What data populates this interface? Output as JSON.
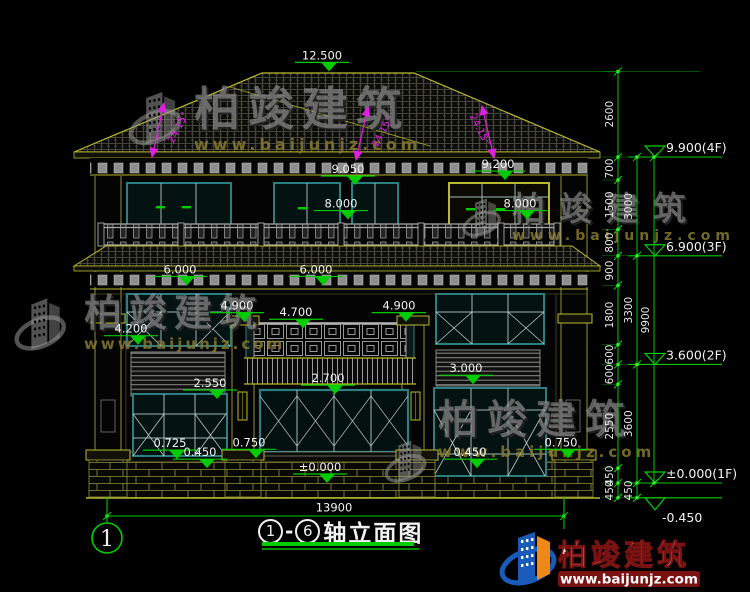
{
  "title_bar": {
    "axis_from": "1",
    "axis_to": "6",
    "dash": "-",
    "title_text": "轴立面图"
  },
  "axis_bubble_label": "1",
  "bottom_dim": {
    "total_width": "13900"
  },
  "building_markers": [
    {
      "label": "12.500",
      "x": 322,
      "mm": 12500
    },
    {
      "label": "9.050",
      "x": 348,
      "mm": 9050
    },
    {
      "label": "9.200",
      "x": 498,
      "mm": 9200
    },
    {
      "label": "8.000",
      "x": 341,
      "mm": 8000
    },
    {
      "label": "8.000",
      "x": 520,
      "mm": 8000
    },
    {
      "label": "6.000",
      "x": 180,
      "mm": 6000
    },
    {
      "label": "6.000",
      "x": 316,
      "mm": 6000
    },
    {
      "label": "4.900",
      "x": 237,
      "mm": 4900
    },
    {
      "label": "4.700",
      "x": 296,
      "mm": 4700
    },
    {
      "label": "4.900",
      "x": 399,
      "mm": 4900
    },
    {
      "label": "4.200",
      "x": 131,
      "mm": 4200
    },
    {
      "label": "3.000",
      "x": 466,
      "mm": 3000
    },
    {
      "label": "2.700",
      "x": 328,
      "mm": 2700
    },
    {
      "label": "2.550",
      "x": 210,
      "mm": 2550
    },
    {
      "label": "0.725",
      "x": 170,
      "mm": 725
    },
    {
      "label": "0.750",
      "x": 249,
      "mm": 750
    },
    {
      "label": "0.450",
      "x": 200,
      "mm": 450
    },
    {
      "label": "0.450",
      "x": 470,
      "mm": 450
    },
    {
      "label": "0.750",
      "x": 561,
      "mm": 750
    },
    {
      "label": "±0.000",
      "x": 320,
      "mm": 0
    }
  ],
  "floor_labels": [
    {
      "label": "9.900(4F)",
      "mm": 9900
    },
    {
      "label": "6.900(3F)",
      "mm": 6900
    },
    {
      "label": "3.600(2F)",
      "mm": 3600
    },
    {
      "label": "±0.000(1F)",
      "mm": 0
    },
    {
      "label": "-0.450",
      "mm": -450,
      "inverted": true
    }
  ],
  "dim_chains": [
    {
      "name": "inner",
      "x": 618,
      "boundaries_mm": [
        12500,
        9900,
        9200,
        7700,
        6900,
        6000,
        4200,
        3600,
        3000,
        450,
        0,
        -450
      ],
      "labels": [
        "2600",
        "700",
        "1500",
        "800",
        "900",
        "1800",
        "600",
        "600",
        "2550",
        "450",
        "450"
      ]
    },
    {
      "name": "middle",
      "x": 637,
      "boundaries_mm": [
        9900,
        6900,
        3600,
        0,
        -450
      ],
      "labels": [
        "3000",
        "3300",
        "3600",
        "450"
      ]
    },
    {
      "name": "outer",
      "x": 654,
      "boundaries_mm": [
        9900,
        0
      ],
      "labels": [
        "9900"
      ]
    }
  ],
  "slope_annotations": [
    {
      "text": "24.15°",
      "x1": 164,
      "y1": 103,
      "x2": 152,
      "y2": 157,
      "tx": 181,
      "ty": 129,
      "rot": -63
    },
    {
      "text": "24.15°",
      "x1": 368,
      "y1": 107,
      "x2": 356,
      "y2": 160,
      "tx": 385,
      "ty": 133,
      "rot": -63
    },
    {
      "text": "24.15°",
      "x1": 482,
      "y1": 106,
      "x2": 494,
      "y2": 158,
      "tx": 477,
      "ty": 131,
      "rot": 63
    }
  ],
  "watermark": {
    "brand": "柏竣建筑",
    "site": "www.baijunjz.com"
  },
  "logo": {
    "brand": "柏竣建筑",
    "site": "www.baijunjz.com"
  },
  "colors": {
    "dim_green": "#00cc00",
    "tick_green": "#33ee33",
    "marker_text": "#f2f2f2",
    "magenta": "#e020e0",
    "trim_yellow": "#b9b92e",
    "teal": "#2a8080",
    "logo_blue": "#1a5ab8",
    "logo_orange": "#ee8818",
    "maroon": "#7a1212"
  }
}
